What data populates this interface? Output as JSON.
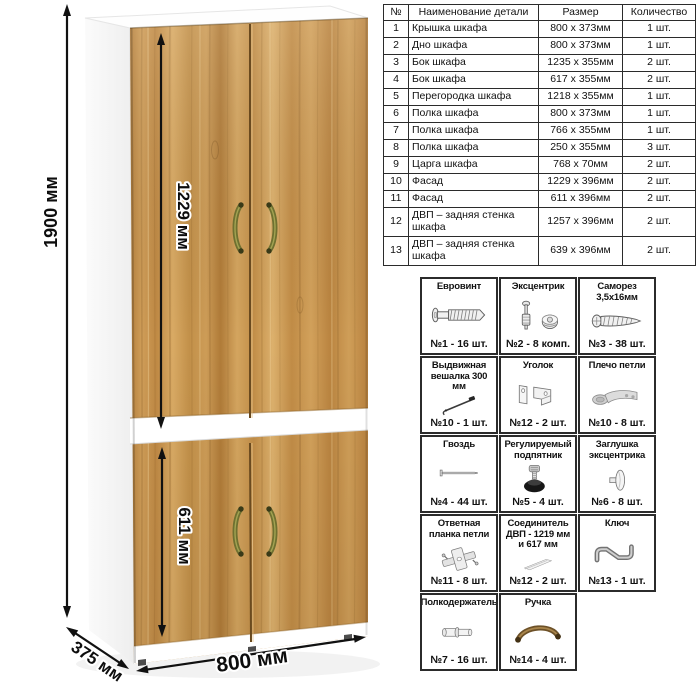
{
  "illustration": {
    "height_label": "1900 мм",
    "upper_facade_label": "1229 мм",
    "lower_facade_label": "611 мм",
    "width_label": "800 мм",
    "depth_label": "375 мм",
    "colors": {
      "wood": "#c9954f",
      "carcass": "#ffffff",
      "handle": "#6f7030",
      "dimension": "#111111"
    }
  },
  "parts_table": {
    "headers": [
      "№",
      "Наименование детали",
      "Размер",
      "Количество"
    ],
    "rows": [
      {
        "num": "1",
        "name": "Крышка шкафа",
        "size": "800 x 373мм",
        "qty": "1 шт."
      },
      {
        "num": "2",
        "name": "Дно шкафа",
        "size": "800 x 373мм",
        "qty": "1 шт."
      },
      {
        "num": "3",
        "name": "Бок шкафа",
        "size": "1235 x 355мм",
        "qty": "2 шт."
      },
      {
        "num": "4",
        "name": "Бок шкафа",
        "size": "617 x 355мм",
        "qty": "2 шт."
      },
      {
        "num": "5",
        "name": "Перегородка шкафа",
        "size": "1218 x 355мм",
        "qty": "1 шт."
      },
      {
        "num": "6",
        "name": "Полка шкафа",
        "size": "800 x 373мм",
        "qty": "1 шт."
      },
      {
        "num": "7",
        "name": "Полка шкафа",
        "size": "766 x 355мм",
        "qty": "1 шт."
      },
      {
        "num": "8",
        "name": "Полка шкафа",
        "size": "250 x 355мм",
        "qty": "3 шт."
      },
      {
        "num": "9",
        "name": "Царга шкафа",
        "size": "768 x 70мм",
        "qty": "2 шт."
      },
      {
        "num": "10",
        "name": "Фасад",
        "size": "1229 x 396мм",
        "qty": "2 шт."
      },
      {
        "num": "11",
        "name": "Фасад",
        "size": "611 x 396мм",
        "qty": "2 шт."
      },
      {
        "num": "12",
        "name": "ДВП – задняя стенка шкафа",
        "size": "1257 x 396мм",
        "qty": "2 шт."
      },
      {
        "num": "13",
        "name": "ДВП – задняя стенка шкафа",
        "size": "639 x 396мм",
        "qty": "2 шт."
      }
    ]
  },
  "hardware": {
    "items": [
      {
        "name": "Евровинт",
        "count": "№1 - 16 шт.",
        "icon": "confirmat-screw-icon"
      },
      {
        "name": "Эксцентрик",
        "count": "№2 - 8 комп.",
        "icon": "cam-lock-icon"
      },
      {
        "name": "Саморез 3,5x16мм",
        "count": "№3 - 38 шт.",
        "icon": "screw-icon"
      },
      {
        "name": "Выдвижная вешалка 300 мм",
        "count": "№10 - 1 шт.",
        "icon": "pullout-hanger-icon"
      },
      {
        "name": "Уголок",
        "count": "№12 - 2 шт.",
        "icon": "corner-bracket-icon"
      },
      {
        "name": "Плечо петли",
        "count": "№10 - 8 шт.",
        "icon": "hinge-arm-icon"
      },
      {
        "name": "Гвоздь",
        "count": "№4 - 44 шт.",
        "icon": "nail-icon"
      },
      {
        "name": "Регулируемый подпятник",
        "count": "№5 - 4 шт.",
        "icon": "adjustable-foot-icon"
      },
      {
        "name": "Заглушка эксцентрика",
        "count": "№6 - 8 шт.",
        "icon": "cam-cover-icon"
      },
      {
        "name": "Ответная планка петли",
        "count": "№11 - 8 шт.",
        "icon": "hinge-plate-icon"
      },
      {
        "name": "Соединитель ДВП - 1219 мм и 617 мм",
        "count": "№12 - 2 шт.",
        "icon": "hdf-connector-icon"
      },
      {
        "name": "Ключ",
        "count": "№13 - 1 шт.",
        "icon": "hex-key-icon"
      },
      {
        "name": "Полкодержатель",
        "count": "№7 - 16 шт.",
        "icon": "shelf-pin-icon"
      },
      {
        "name": "Ручка",
        "count": "№14 - 4 шт.",
        "icon": "handle-icon"
      }
    ]
  }
}
